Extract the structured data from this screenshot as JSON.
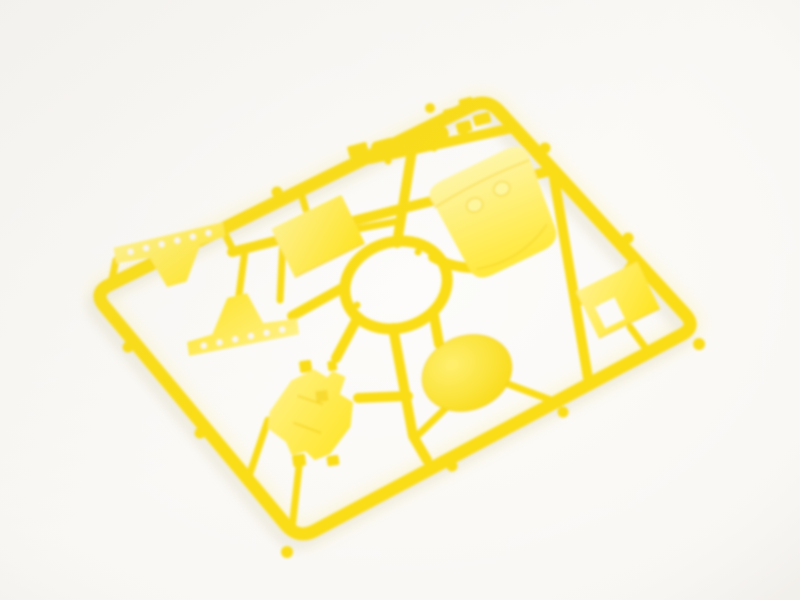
{
  "scene": {
    "type": "photograph",
    "subject": "Bright yellow injection-molded plastic model-kit sprue (parts runner) with attached unassembled parts",
    "background_surface": "plain white seamless surface",
    "camera": "slightly elevated oblique angle, sprue lying diagonally, soft focus / shallow depth of field",
    "object_orientation": "rounded rectangular runner frame tilted roughly -26 degrees with a circular hub ring at its center and runners radiating to each part"
  },
  "colors": {
    "base": "#FADD18",
    "deep": "#EFC702",
    "light": "#FFF6A0",
    "face_hi": "#FFF28C",
    "face_lo": "#FFE41F",
    "shell_hi": "#FFF6A8",
    "shell_lo": "#FFE838",
    "disc_hi": "#FFEF6E",
    "disc_lo": "#F8D90B",
    "hole": "#FAF8F4",
    "background": "#FDFCFA",
    "shadow": "#E8E5DF",
    "glow": "#FFF0A0"
  },
  "sprue": {
    "frame_shape": "rounded rectangle runner frame",
    "hub": "central circular ring with radiating runner spokes",
    "nub_count": 10,
    "parts": [
      {
        "id": "small-fittings-row",
        "description": "row of small cylindrical and block fittings in the top compartment",
        "count": 9,
        "position": "top, near upper corner"
      },
      {
        "id": "rectangular-panel",
        "description": "flat rectangular panel",
        "position": "upper middle-left"
      },
      {
        "id": "cowl-shell",
        "description": "curved shell / cowl piece with two round bosses near its top edge",
        "position": "upper right of hub ring"
      },
      {
        "id": "gusset-plate-upper",
        "description": "triangular gusset plate with a row of six small through-holes",
        "position": "left compartment, upper"
      },
      {
        "id": "gusset-plate-lower",
        "description": "triangular gusset plate with a row of six small through-holes, flipped orientation",
        "position": "left compartment, lower"
      },
      {
        "id": "notched-panel",
        "description": "rectangular panel with a rectangular cutout",
        "position": "right compartment"
      },
      {
        "id": "round-disc",
        "description": "solid circular disc",
        "position": "lower right of hub ring"
      },
      {
        "id": "chassis-block",
        "description": "angular bracket / chassis block with small pegs and feet",
        "position": "lower left compartment"
      }
    ]
  }
}
